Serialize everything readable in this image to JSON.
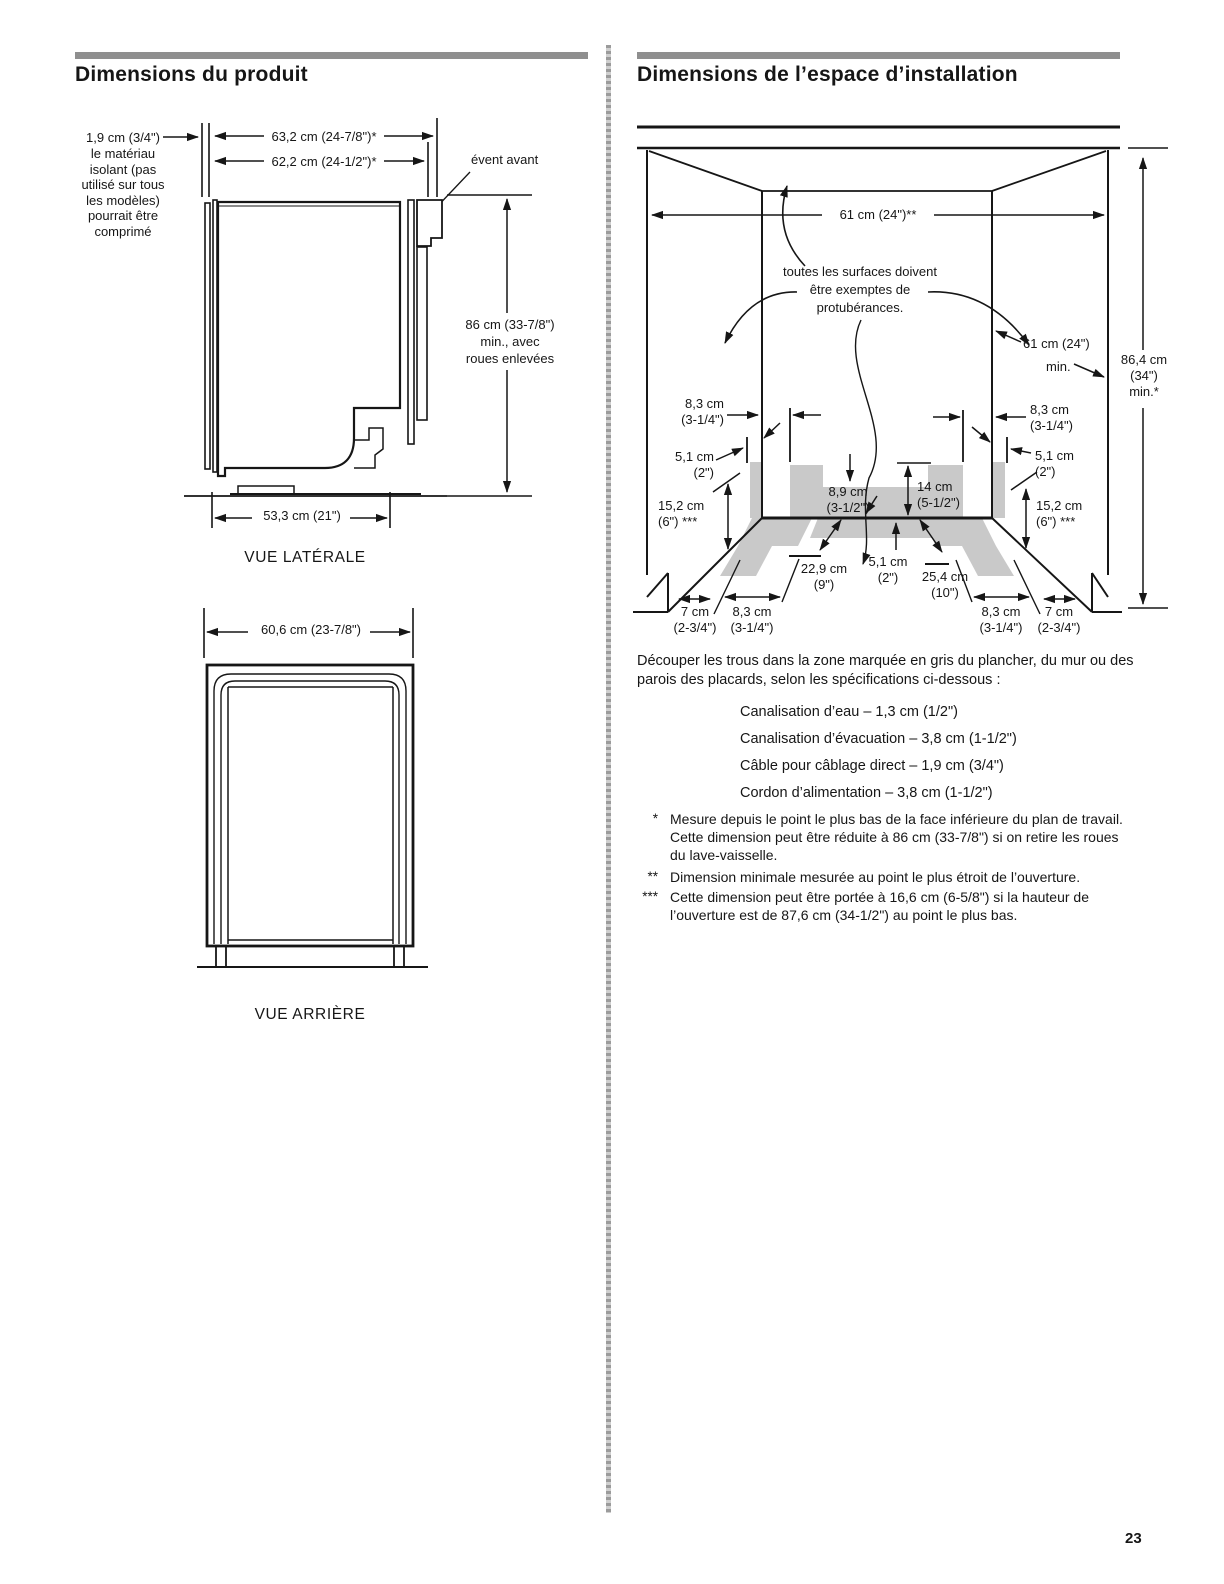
{
  "page": {
    "number": "23"
  },
  "left_column": {
    "heading": "Dimensions du produit",
    "side_view": {
      "caption": "VUE LATÉRALE",
      "insulation_dim": "1,9 cm (3/4\")",
      "insulation_note": "le matériau\nisolant (pas\nutilisé sur tous\nles modèles)\npourrait être\ncomprimé",
      "width_outer": "63,2 cm (24-7/8\")*",
      "width_inner": "62,2 cm (24-1/2\")*",
      "front_vent": "évent avant",
      "height": "86 cm (33-7/8\")\nmin., avec\nroues enlevées",
      "depth": "53,3 cm (21\")"
    },
    "rear_view": {
      "caption": "VUE ARRIÈRE",
      "width": "60,6 cm (23-7/8\")"
    }
  },
  "right_column": {
    "heading": "Dimensions de l’espace d’installation",
    "diagram": {
      "opening_width": "61 cm (24\")**",
      "surfaces_note": "toutes les surfaces doivent\nêtre exemptes de\nprotubérances.",
      "depth_value": "61 cm (24\")",
      "depth_min": "min.",
      "height": "86,4 cm\n(34\")\nmin.*",
      "left_upper": "8,3 cm\n(3-1/4\")",
      "right_upper": "8,3 cm\n(3-1/4\")",
      "left_mid": "5,1 cm\n(2\")",
      "right_mid": "5,1 cm\n(2\")",
      "left_lower": "15,2 cm\n(6\") ***",
      "right_lower": "15,2 cm\n(6\") ***",
      "center_upper": "8,9 cm\n(3-1/2\")",
      "center_right": "14 cm\n(5-1/2\")",
      "floor_left": "22,9 cm\n(9\")",
      "floor_center": "5,1 cm\n(2\")",
      "floor_right": "25,4 cm\n(10\")",
      "bottom_left_1": "7 cm\n(2-3/4\")",
      "bottom_left_2": "8,3 cm\n(3-1/4\")",
      "bottom_right_1": "8,3 cm\n(3-1/4\")",
      "bottom_right_2": "7 cm\n(2-3/4\")"
    },
    "cutout": {
      "intro": "Découper les trous dans la zone marquée en gris du plancher, du mur ou des\nparois des placards, selon les spécifications ci-dessous :",
      "specs": [
        "Canalisation d’eau – 1,3 cm (1/2\")",
        "Canalisation d’évacuation – 3,8 cm (1-1/2\")",
        "Câble pour câblage direct – 1,9 cm (3/4\")",
        "Cordon d’alimentation – 3,8 cm (1-1/2\")"
      ],
      "footnotes": [
        {
          "marker": "*",
          "text": "Mesure depuis le point le plus bas de la face inférieure du plan de travail.\nCette dimension peut être réduite à 86 cm (33-7/8\") si on retire les roues\ndu lave-vaisselle."
        },
        {
          "marker": "**",
          "text": "Dimension minimale mesurée au point le plus étroit de l’ouverture."
        },
        {
          "marker": "***",
          "text": "Cette dimension peut être portée à 16,6 cm (6-5/8\") si la hauteur de\nl’ouverture est de 87,6 cm (34-1/2\") au point le plus bas."
        }
      ]
    }
  }
}
